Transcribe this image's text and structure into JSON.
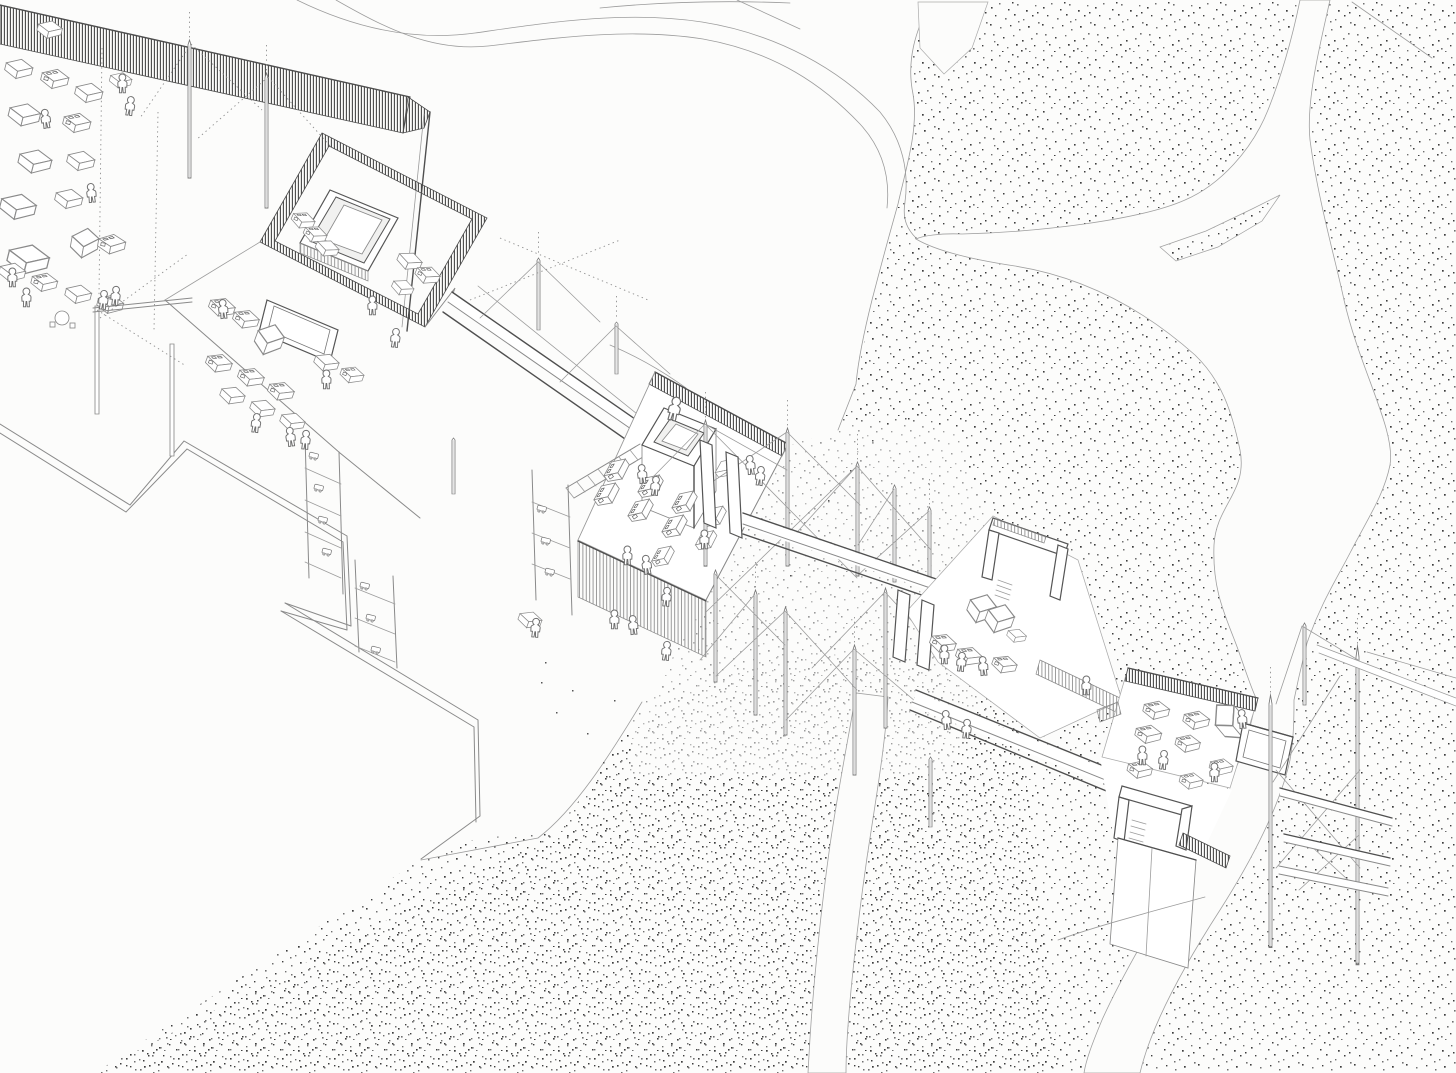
{
  "artwork": {
    "title": "Axonometric site drawing of linked pavilions over a braided river landscape",
    "aria_label": "Hand-drawn pencil axonometric architectural drawing: a chain of open pavilions filled with furniture, market stalls and small human figures, connected by elevated walkways, guyed masts and cross-braced trestle towers, set on white terraces above a stippled gravel landscape cut by winding white river channels",
    "medium": "pencil line drawing with stippled ground texture",
    "palette": {
      "background": "#fcfcfb",
      "line": "#8a8a8a",
      "dark_line": "#4f4f4f",
      "hatch": "#4c4c4c",
      "stipple": "#3d3d3d"
    },
    "components": [
      {
        "id": "dormitory-pavilion",
        "label": "north-west pavilion with hatched roof band, beds and figures"
      },
      {
        "id": "courtyard-house",
        "label": "square courtyard pavilion with hatched wall ring"
      },
      {
        "id": "logistics-terrace",
        "label": "terrace with desks, shelving racks and small carts"
      },
      {
        "id": "market-pavilion",
        "label": "central pavilion with stall counters and rooftop court"
      },
      {
        "id": "mast-field",
        "label": "guyed masts and cross-braced trestles"
      },
      {
        "id": "office-platform",
        "label": "raised platform with stair rooms and desks"
      },
      {
        "id": "riverside-pavilion",
        "label": "east pavilion standing on a concrete pier"
      },
      {
        "id": "signal-tower",
        "label": "tall cross-braced tower with beams running off frame"
      },
      {
        "id": "walkways",
        "label": "elevated connecting walkway bridges"
      },
      {
        "id": "zigzag-terrace-wall",
        "label": "zig-zag retaining wall of the white terrace"
      },
      {
        "id": "river-channels",
        "label": "white braided river channels through stippled gravel"
      },
      {
        "id": "footpaths",
        "label": "thin curving footpath lines"
      },
      {
        "id": "person-figures",
        "label": "small hooded human silhouettes"
      }
    ]
  }
}
